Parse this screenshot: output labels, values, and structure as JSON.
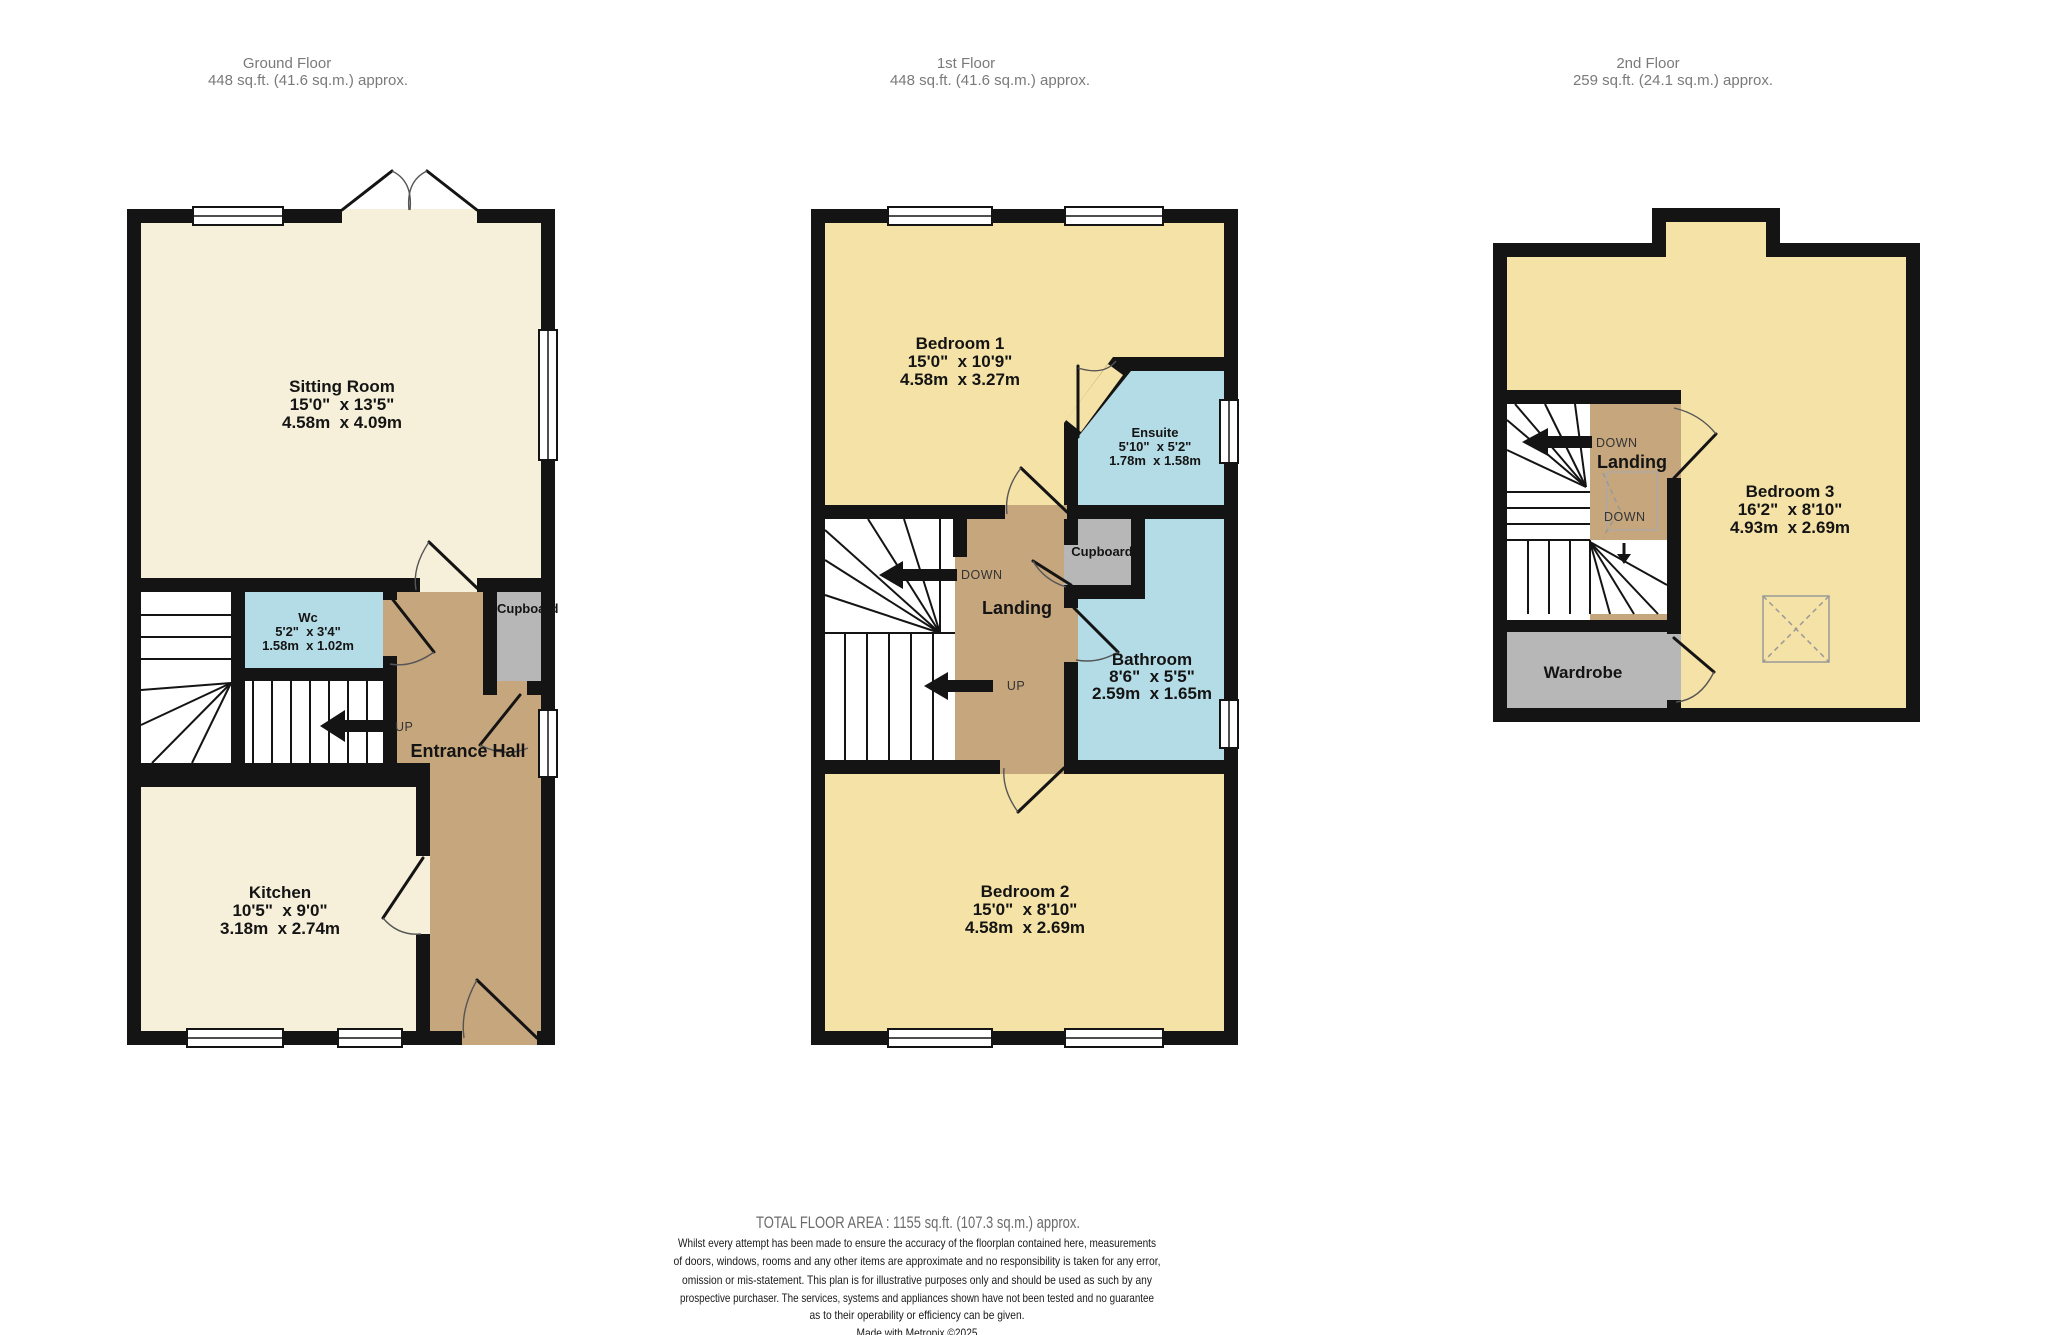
{
  "colors": {
    "wall": "#141414",
    "cream_room": "#f6f0da",
    "yellow_room": "#f5e2a6",
    "blue_room": "#b4dce6",
    "hall_tan": "#c6a67d",
    "cupboard_gray": "#b7b7b7",
    "header_text": "#7a7a7a",
    "footer_text": "#6b6b6b"
  },
  "floors": {
    "ground": {
      "title": "Ground Floor",
      "area": "448 sq.ft. (41.6 sq.m.) approx.",
      "rooms": {
        "sitting_room": {
          "name": "Sitting Room",
          "imperial": "15'0\"  x 13'5\"",
          "metric": "4.58m  x 4.09m"
        },
        "wc": {
          "name": "Wc",
          "imperial": "5'2\"  x 3'4\"",
          "metric": "1.58m  x 1.02m"
        },
        "entrance_hall": {
          "name": "Entrance Hall"
        },
        "cupboard": {
          "name": "Cupboard"
        },
        "kitchen": {
          "name": "Kitchen",
          "imperial": "10'5\"  x 9'0\"",
          "metric": "3.18m  x 2.74m"
        }
      },
      "labels": {
        "up": "UP"
      }
    },
    "first": {
      "title": "1st Floor",
      "area": "448 sq.ft. (41.6 sq.m.) approx.",
      "rooms": {
        "bedroom1": {
          "name": "Bedroom 1",
          "imperial": "15'0\"  x 10'9\"",
          "metric": "4.58m  x 3.27m"
        },
        "ensuite": {
          "name": "Ensuite",
          "imperial": "5'10\"  x 5'2\"",
          "metric": "1.78m  x 1.58m"
        },
        "landing": {
          "name": "Landing"
        },
        "cupboard": {
          "name": "Cupboard"
        },
        "bathroom": {
          "name": "Bathroom",
          "imperial": "8'6\"  x 5'5\"",
          "metric": "2.59m  x 1.65m"
        },
        "bedroom2": {
          "name": "Bedroom 2",
          "imperial": "15'0\"  x 8'10\"",
          "metric": "4.58m  x 2.69m"
        }
      },
      "labels": {
        "down": "DOWN",
        "up": "UP"
      }
    },
    "second": {
      "title": "2nd Floor",
      "area": "259 sq.ft. (24.1 sq.m.) approx.",
      "rooms": {
        "landing": {
          "name": "Landing"
        },
        "bedroom3": {
          "name": "Bedroom 3",
          "imperial": "16'2\"  x 8'10\"",
          "metric": "4.93m  x 2.69m"
        },
        "wardrobe": {
          "name": "Wardrobe"
        }
      },
      "labels": {
        "down1": "DOWN",
        "down2": "DOWN"
      }
    }
  },
  "footer": {
    "total": "TOTAL FLOOR AREA : 1155 sq.ft. (107.3 sq.m.) approx.",
    "disclaimer_lines": [
      "Whilst every attempt has been made to ensure the accuracy of the floorplan contained here, measurements",
      "of doors, windows, rooms and any other items are approximate and no responsibility is taken for any error,",
      "omission or mis-statement. This plan is for illustrative purposes only and should be used as such by any",
      "prospective purchaser. The services, systems and appliances shown have not been tested and no guarantee",
      "as to their operability or efficiency can be given."
    ],
    "credit": "Made with Metropix ©2025"
  }
}
